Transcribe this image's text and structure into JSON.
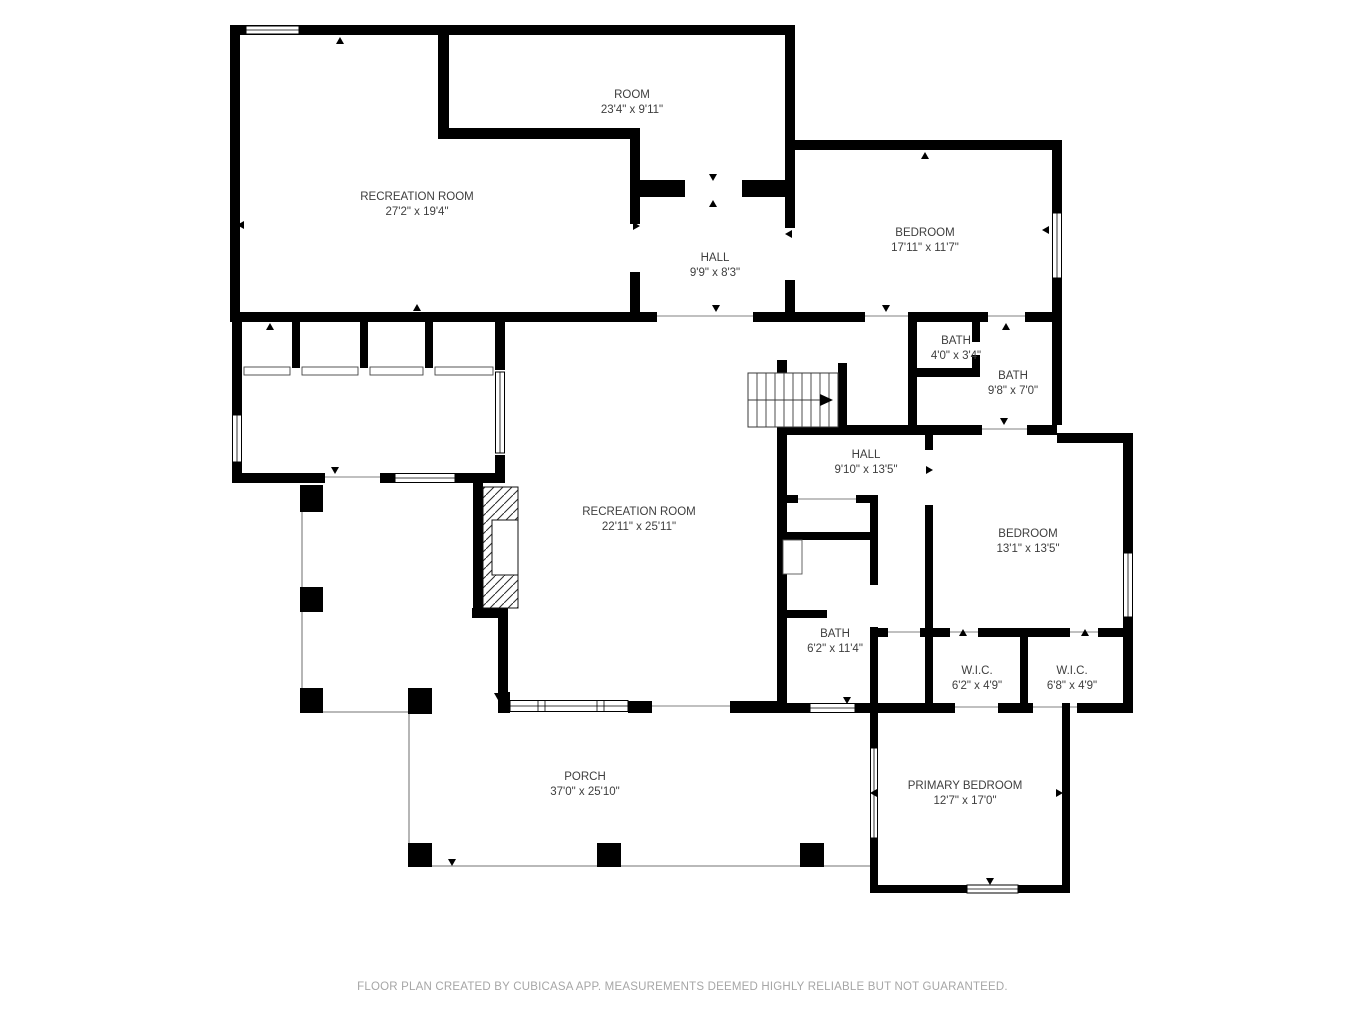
{
  "meta": {
    "app": "floor-plan",
    "background": "#ffffff",
    "colors": {
      "wall": "#000000",
      "label_text": "#3e3e3e",
      "porch_line": "#8f8f8f",
      "opening_line": "#9a9a9a",
      "footer_text": "#a6a6a6"
    }
  },
  "rooms": [
    {
      "name": "ROOM",
      "dims": "23'4\" x 9'11\""
    },
    {
      "name": "RECREATION ROOM",
      "dims": "27'2\" x 19'4\""
    },
    {
      "name": "HALL",
      "dims": "9'9\" x 8'3\""
    },
    {
      "name": "BEDROOM",
      "dims": "17'11\" x 11'7\""
    },
    {
      "name": "BATH",
      "dims": "4'0\" x 3'4\""
    },
    {
      "name": "BATH",
      "dims": "9'8\" x 7'0\""
    },
    {
      "name": "HALL",
      "dims": "9'10\" x 13'5\""
    },
    {
      "name": "RECREATION ROOM",
      "dims": "22'11\" x 25'11\""
    },
    {
      "name": "BEDROOM",
      "dims": "13'1\" x 13'5\""
    },
    {
      "name": "BATH",
      "dims": "6'2\" x 11'4\""
    },
    {
      "name": "W.I.C.",
      "dims": "6'2\" x 4'9\""
    },
    {
      "name": "W.I.C.",
      "dims": "6'8\" x 4'9\""
    },
    {
      "name": "PORCH",
      "dims": "37'0\" x 25'10\""
    },
    {
      "name": "PRIMARY BEDROOM",
      "dims": "12'7\" x 17'0\""
    }
  ],
  "footer": {
    "text": "FLOOR PLAN CREATED BY CUBICASA APP. MEASUREMENTS DEEMED HIGHLY RELIABLE BUT NOT GUARANTEED."
  }
}
